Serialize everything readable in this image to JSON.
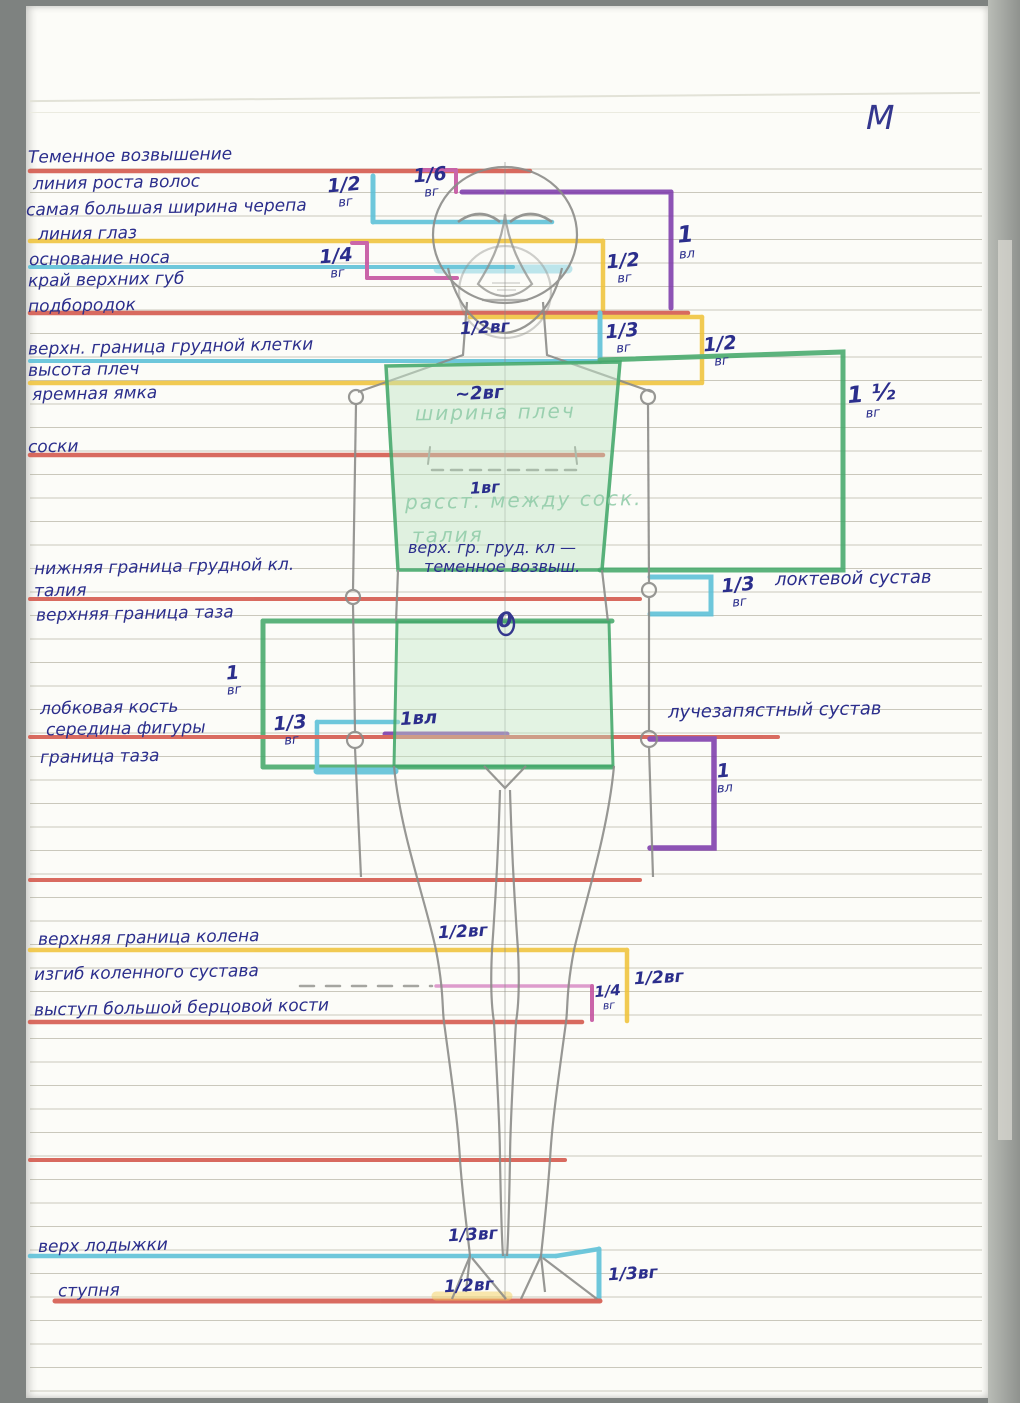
{
  "page": {
    "corner_mark": "М",
    "zero_mark": "0"
  },
  "colors": {
    "red": "#d4574a",
    "cyan": "#5bc0d8",
    "yellow": "#f0c43c",
    "magenta": "#c4519f",
    "purple": "#7e3cac",
    "green": "#46a96b",
    "ink": "#2b2e8c",
    "pencil": "#8c8c88"
  },
  "left_labels": [
    "Теменное возвышение",
    "линия роста волос",
    "самая большая ширина черепа",
    "линия глаз",
    "основание носа",
    "край верхних губ",
    "подбородок",
    "верхн. граница грудной клетки",
    "высота плеч",
    "яремная ямка",
    "соски",
    "нижняя граница грудной кл.",
    "талия",
    "верхняя граница таза",
    "лобковая кость",
    "середина фигуры",
    "граница таза",
    "верхняя граница колена",
    "изгиб коленного сустава",
    "выступ большой берцовой кости",
    "верх лодыжки",
    "ступня"
  ],
  "right_labels": {
    "elbow": "локтевой сустав",
    "wrist": "лучезапястный сустав"
  },
  "figure_notes": {
    "shoulder_width_value": "~2вг",
    "shoulder_width": "ширина плеч",
    "nipple_distance_value": "1вг",
    "nipple_distance": "расст. между соск.",
    "waist": "талия",
    "note_line1": "верх. гр. груд. кл —",
    "note_line2": "теменное возвыш."
  },
  "measurements": {
    "crown_skull": {
      "v": "1/2",
      "u": "вг"
    },
    "crown_hairline": {
      "v": "1/6",
      "u": "вг"
    },
    "hairline_chin": {
      "v": "1",
      "u": "вл"
    },
    "eyes_lip": {
      "v": "1/4",
      "u": "вг"
    },
    "eyes_chin": {
      "v": "1/2",
      "u": "вг"
    },
    "head_half": {
      "t": "1/2вг"
    },
    "chin_chest": {
      "v": "1/3",
      "u": "вг"
    },
    "chin_shoulder": {
      "v": "1/2",
      "u": "вг"
    },
    "shoulder_chest": {
      "v": "1 ½",
      "u": "вг"
    },
    "elbow": {
      "v": "1/3",
      "u": "вг"
    },
    "pelvis_height": {
      "v": "1",
      "u": "вг"
    },
    "pubis_pelvis": {
      "v": "1/3",
      "u": "вг"
    },
    "hand_length": {
      "t": "1вл"
    },
    "wrist_hand": {
      "v": "1",
      "u": "вл"
    },
    "knee_top": {
      "t": "1/2вг"
    },
    "knee_span": {
      "t": "1/2вг"
    },
    "knee_quarter": {
      "v": "1/4",
      "u": "вг"
    },
    "ankle_top": {
      "t": "1/3вг"
    },
    "foot_span": {
      "t": "1/2вг"
    },
    "ankle_foot": {
      "t": "1/3вг"
    }
  }
}
